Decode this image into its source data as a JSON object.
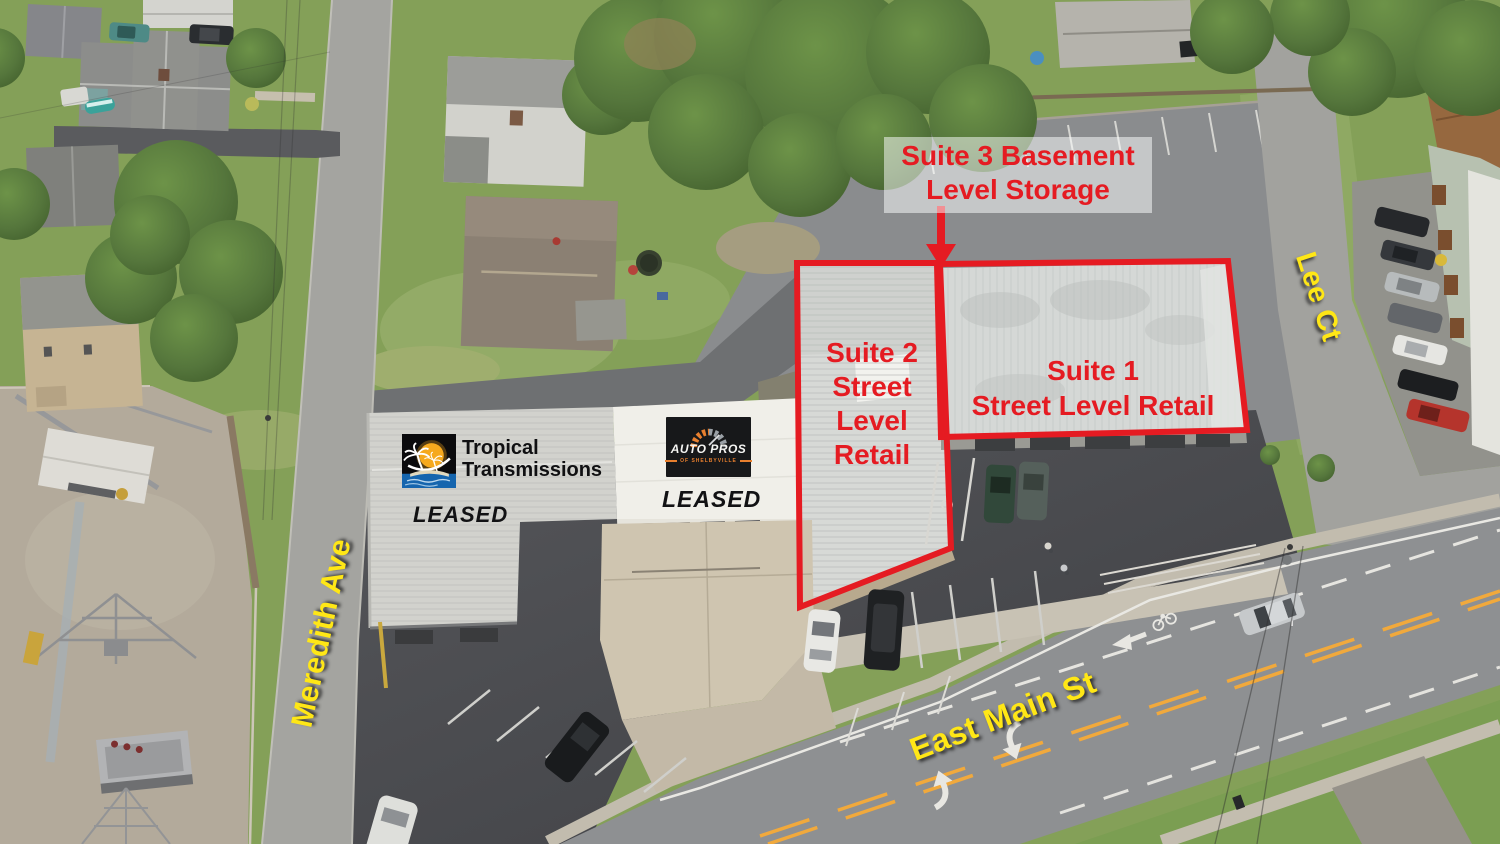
{
  "colors": {
    "annotation_red": "#E51B22",
    "street_label_yellow": "#FFE716",
    "autopros_orange": "#E87F2E",
    "tropical_logo_blue": "#1565AE",
    "tropical_logo_sun": "#F6A91E"
  },
  "annotations": {
    "suite3_storage": {
      "line1": "Suite 3 Basement",
      "line2": "Level Storage"
    },
    "suite2": {
      "line1": "Suite 2",
      "line2": "Street",
      "line3": "Level",
      "line4": "Retail"
    },
    "suite1": {
      "line1": "Suite 1",
      "line2": "Street Level Retail"
    },
    "leased_left": "LEASED",
    "leased_right": "LEASED"
  },
  "logos": {
    "tropical_transmissions": {
      "line1": "Tropical",
      "line2": "Transmissions"
    },
    "auto_pros": {
      "name": "AUTO PROS",
      "subtitle": "OF SHELBYVILLE"
    }
  },
  "street_labels": {
    "meredith": "Meredith Ave",
    "lee": "Lee Ct",
    "east_main": "East Main St"
  }
}
